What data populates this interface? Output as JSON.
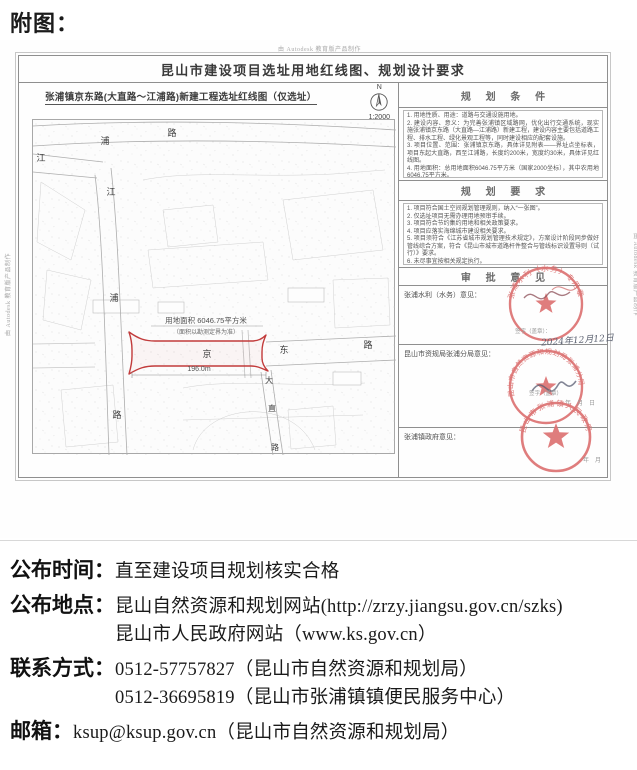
{
  "page": {
    "attachment_label": "附图："
  },
  "document": {
    "watermark": "由 Autodesk 教育版产品制作",
    "title": "昆山市建设项目选址用地红线图、规划设计要求",
    "map": {
      "title": "张浦镇京东路(大直路～江浦路)新建工程选址红线图（仅选址）",
      "north_label": "N",
      "scale": "1:2000",
      "area_line1": "用地面积 6046.75平方米",
      "area_line2": "（面积以勘测定界为准）",
      "dimension": "196.0m",
      "roads": {
        "jiangpu_nw": "江",
        "jiangpu_top_1": "浦",
        "jiangpu_top_2": "路",
        "jiangpu_v": [
          "江",
          "浦",
          "路"
        ],
        "jingdong": [
          "京",
          "东",
          "路"
        ],
        "dazhi": [
          "大",
          "直",
          "路"
        ]
      }
    },
    "sections": {
      "conditions": {
        "title": "规 划 条 件",
        "items": [
          "1. 用地性质、用途：道路与交通设施用地。",
          "2. 建设内容、意义：为完善张浦镇区域路网，优化出行交通系统，现实施张浦镇京东路（大直路—江浦路）新建工程，建设内容主要包括道路工程、排水工程、绿化景观工程等，同时建设相应的配套设施。",
          "3. 项目位置、范围：张浦镇京东路，具体详见附表——界址点坐标表，项目东起大直路，西至江浦路，长度约200米，宽度约30米，具体详见红线图。",
          "4. 用地面积：总用地面积6046.75平方米（国家2000坐标），其中农用地6046.75平方米。"
        ]
      },
      "requirements": {
        "title": "规 划 要 求",
        "items": [
          "1. 项目符合国土空间规划管理规则，纳入“一张图”。",
          "2. 仅选址项目无需办理用地预审手续。",
          "3. 项目符合节约集约用地和相关政策要求。",
          "4. 项目应落实海绵城市建设相关要求。",
          "5. 项目须符合《江苏省城市规划管理技术规定》，方案设计阶段同步做好管线综合方案，符合《昆山市城市道路杆件整合与管线标识设置导则（试行）》要求。",
          "6. 未尽事宜按相关规定执行。"
        ],
        "note": "注意：经以下三部门审批后，本图方正式有效。"
      },
      "approval": {
        "title": "审 批 意 见",
        "blocks": [
          {
            "label": "张浦水利（水务）意见：",
            "sign_hint": "签字（盖章）：",
            "date": "2024年12月12日",
            "stamp_text": "张浦水利（水务）专用章"
          },
          {
            "label": "昆山市资规局张浦分局意见：",
            "sign_hint": "签字（盖章）",
            "date": "年　月　日",
            "stamp_text": "昆山市自然资源和规划局张浦分局"
          },
          {
            "label": "张浦镇政府意见：",
            "date": "年　月",
            "stamp_text": "昆山市张浦镇人民政府"
          }
        ]
      }
    }
  },
  "footer": {
    "rows": [
      {
        "label": "公布时间：",
        "lines": [
          "直至建设项目规划核实合格"
        ]
      },
      {
        "label": "公布地点：",
        "lines": [
          "昆山自然资源和规划网站(http://zrzy.jiangsu.gov.cn/szks)",
          "昆山市人民政府网站（www.ks.gov.cn）"
        ]
      },
      {
        "label": "联系方式：",
        "lines": [
          "0512-57757827（昆山市自然资源和规划局）",
          "0512-36695819（昆山市张浦镇镇便民服务中心）"
        ]
      },
      {
        "label": "邮箱：",
        "lines": [
          "ksup@ksup.gov.cn（昆山市自然资源和规划局）"
        ]
      }
    ]
  },
  "colors": {
    "redline": "#c23b3b",
    "stamp": "#dd7373"
  }
}
